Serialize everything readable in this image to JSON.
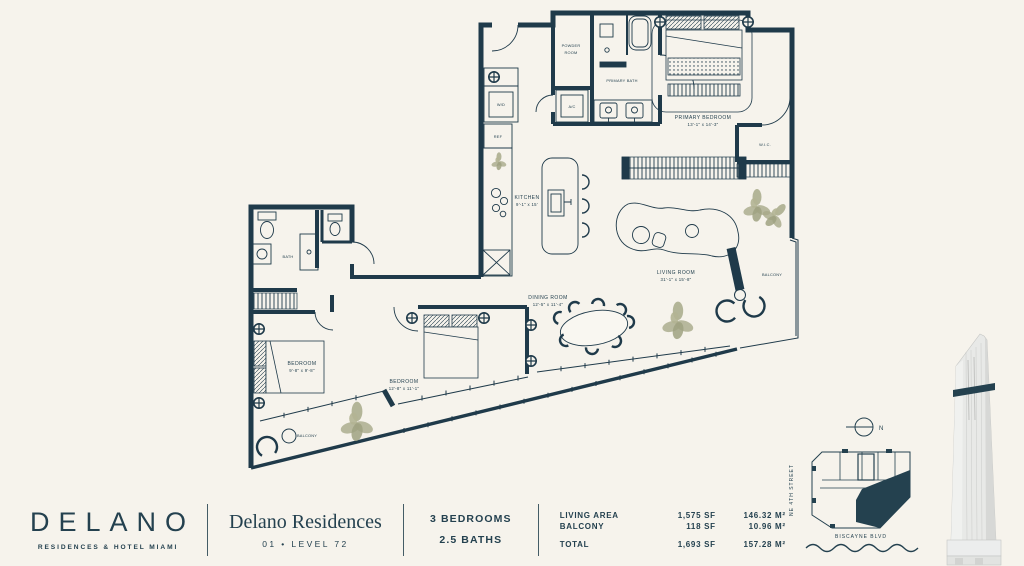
{
  "theme": {
    "background": "#f6f3ec",
    "ink": "#1f3a4a",
    "plant": "#a7a989"
  },
  "plan": {
    "rooms": {
      "powder_line1": "POWDER",
      "powder_line2": "ROOM",
      "primary_bath": "PRIMARY BATH",
      "ac": "A/C",
      "wd": "W/D",
      "ref": "REF",
      "primary_bedroom": "PRIMARY BEDROOM",
      "primary_bedroom_dims": "13'-1\" x 14'-3\"",
      "wic": "W.I.C.",
      "kitchen": "KITCHEN",
      "kitchen_dims": "9'-1\" x 15'",
      "living": "LIVING ROOM",
      "living_dims": "31'-1\" x 15'-8\"",
      "dining": "DINING ROOM",
      "dining_dims": "12'-5\" x 11'-4\"",
      "bath": "BATH",
      "bedroom2": "BEDROOM",
      "bedroom2_dims": "9'-8\" x 9'-8\"",
      "bedroom3": "BEDROOM",
      "bedroom3_dims": "12'-8\" x 11'-1\"",
      "balcony_left": "BALCONY",
      "balcony_right": "BALCONY"
    }
  },
  "footer": {
    "brand": {
      "name": "DELANO",
      "tagline": "RESIDENCES & HOTEL MIAMI"
    },
    "residence": {
      "title": "Delano Residences",
      "unit_line": "01  •  LEVEL 72"
    },
    "config": {
      "line1": "3 BEDROOMS",
      "line2": "2.5 BATHS"
    },
    "areas": {
      "rows": [
        {
          "label": "LIVING AREA",
          "sf": "1,575 SF",
          "m2": "146.32 M²"
        },
        {
          "label": "BALCONY",
          "sf": "118 SF",
          "m2": "10.96 M²"
        }
      ],
      "total": {
        "label": "TOTAL",
        "sf": "1,693 SF",
        "m2": "157.28 M²"
      }
    }
  },
  "keyplan": {
    "street_side": "NE 4TH STREET",
    "street_bottom": "BISCAYNE BLVD",
    "north": "N"
  }
}
